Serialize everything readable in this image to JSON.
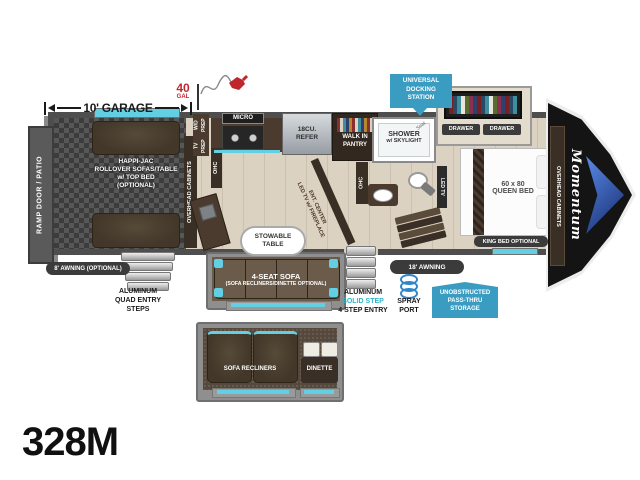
{
  "model": "328M",
  "garage": {
    "dimension": "10' GARAGE",
    "fuel_amount": "40",
    "fuel_unit": "GAL",
    "ramp_door": "RAMP DOOR / PATIO",
    "happijac_l1": "HAPPI-JAC",
    "happijac_l2": "ROLLOVER SOFAS/TABLE",
    "happijac_l3": "w/ TOP BED",
    "happijac_l4": "(OPTIONAL)",
    "tv_prep": "TV PREP",
    "wd_prep": "W/D PREP",
    "overhead_cabinets": "OVERHEAD CABINETS",
    "ohc": "OHC"
  },
  "kitchen": {
    "micro": "MICRO",
    "refer_l1": "18CU.",
    "refer_l2": "REFER",
    "pantry_l1": "WALK IN",
    "pantry_l2": "PANTRY",
    "ent_center_l1": "ENT. CENTER",
    "ent_center_l2": "LED TV w/ FIREPLACE",
    "ohc": "OHC"
  },
  "bath": {
    "shower_l1": "SHOWER",
    "shower_l2": "w/ SKYLIGHT",
    "seat": "Seat",
    "ohc": "OHC"
  },
  "living": {
    "stowable_l1": "STOWABLE",
    "stowable_l2": "TABLE",
    "sofa_l1": "4-SEAT SOFA",
    "sofa_l2": "(SOFA RECLINERS/DINETTE OPTIONAL)"
  },
  "bedroom": {
    "docking_l1": "UNIVERSAL",
    "docking_l2": "DOCKING",
    "docking_l3": "STATION",
    "drawer_left": "DRAWER",
    "drawer_right": "DRAWER",
    "led_tv": "LED TV",
    "bed_size": "60 x 80",
    "bed_type": "QUEEN BED",
    "king_option": "KING BED OPTIONAL",
    "overhead_cabinets": "OVERHEAD CABINETS",
    "brand": "Momentum"
  },
  "exterior": {
    "awning_rear": "8' AWNING (OPTIONAL)",
    "quad_steps_l1": "ALUMINUM",
    "quad_steps_l2": "QUAD ENTRY",
    "quad_steps_l3": "STEPS",
    "entry_l1": "ALUMINUM",
    "entry_l2": "SOLID STEP",
    "entry_l3": "4 STEP ENTRY",
    "spray_l1": "SPRAY",
    "spray_l2": "PORT",
    "passthru_l1": "UNOBSTRUCTED",
    "passthru_l2": "PASS-THRU",
    "passthru_l3": "STORAGE",
    "awning_main": "18' AWNING"
  },
  "inset": {
    "sofa": "SOFA RECLINERS",
    "dinette": "DINETTE"
  },
  "colors": {
    "badge_blue": "#3b9cc2",
    "accent_teal": "#62cfe3",
    "awning_dark": "#3b3b3b",
    "fuel_red": "#c0272d",
    "solid_step_teal": "#2fb4c9"
  }
}
